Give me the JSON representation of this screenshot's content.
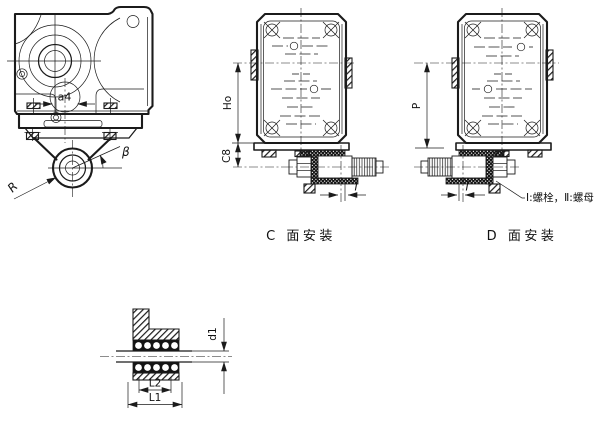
{
  "colors": {
    "background": "#ffffff",
    "ink": "#1b1b1b"
  },
  "front_view": {
    "center_distance_label": "a4",
    "angle_label": "β",
    "radius_label": "R"
  },
  "c_face_view": {
    "caption": "C 面安装",
    "height_dim": "Ho",
    "clearance_dim": "C8",
    "offset_dim": "i"
  },
  "d_face_view": {
    "caption": "D 面安装",
    "height_dim": "P",
    "offset_dim": "i",
    "legend_note": "Ⅰ:螺栓，Ⅱ:螺母"
  },
  "hub_detail": {
    "diameter_dim": "d1",
    "hub_length_dim": "L2",
    "total_length_dim": "L1"
  }
}
